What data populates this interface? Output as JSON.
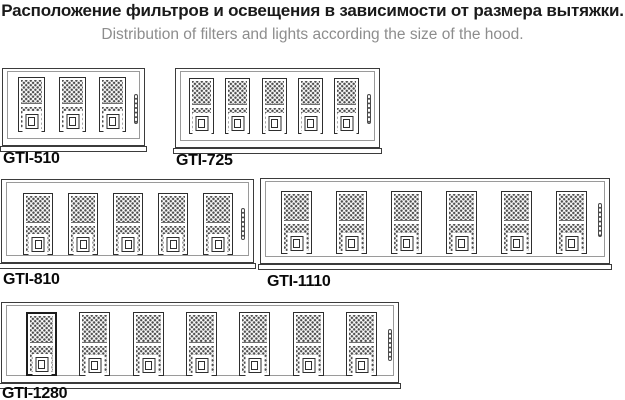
{
  "title_ru": "Расположение фильтров и освещения в зависимости от размера вытяжки.",
  "title_en": "Distribution of filters and lights according the size of the hood.",
  "colors": {
    "background": "#ffffff",
    "title": "#1a1a1a",
    "subtitle": "#8d8d8d",
    "outline": "#3b3b3b",
    "inner_line": "#9a9a9a",
    "mesh_dot": "#4d4d4d",
    "label": "#0a0a0a"
  },
  "hoods": [
    {
      "model": "GTI-510",
      "filters_count": 3,
      "lights_count": 1,
      "frame": {
        "x": 2,
        "y": 68,
        "w": 143,
        "h": 78
      },
      "filters": {
        "xs": [
          15,
          56,
          96
        ],
        "y": 8,
        "w": 27,
        "h": 55
      },
      "light": {
        "x": 131,
        "y": 25,
        "w": 4,
        "h": 30
      },
      "label": {
        "x": 3,
        "y": 150
      }
    },
    {
      "model": "GTI-725",
      "filters_count": 5,
      "lights_count": 1,
      "frame": {
        "x": 175,
        "y": 68,
        "w": 205,
        "h": 80
      },
      "filters": {
        "xs": [
          13,
          49,
          86,
          122,
          158
        ],
        "y": 9,
        "w": 25,
        "h": 56
      },
      "light": {
        "x": 191,
        "y": 25,
        "w": 4,
        "h": 30
      },
      "label": {
        "x": 176,
        "y": 152
      }
    },
    {
      "model": "GTI-810",
      "filters_count": 5,
      "lights_count": 1,
      "frame": {
        "x": 1,
        "y": 179,
        "w": 253,
        "h": 84
      },
      "filters": {
        "xs": [
          21,
          66,
          111,
          156,
          201
        ],
        "y": 13,
        "w": 30,
        "h": 62
      },
      "light": {
        "x": 239,
        "y": 28,
        "w": 4,
        "h": 32
      },
      "label": {
        "x": 3,
        "y": 271
      }
    },
    {
      "model": "GTI-1110",
      "filters_count": 6,
      "lights_count": 1,
      "frame": {
        "x": 260,
        "y": 178,
        "w": 350,
        "h": 86
      },
      "filters": {
        "xs": [
          20,
          75,
          130,
          185,
          240,
          295
        ],
        "y": 12,
        "w": 31,
        "h": 63
      },
      "light": {
        "x": 337,
        "y": 24,
        "w": 4,
        "h": 34
      },
      "label": {
        "x": 267,
        "y": 273
      }
    },
    {
      "model": "GTI-1280",
      "filters_count": 7,
      "lights_count": 1,
      "highlighted_filter": 0,
      "frame": {
        "x": 1,
        "y": 302,
        "w": 398,
        "h": 81
      },
      "filters": {
        "xs": [
          24,
          77,
          131,
          184,
          237,
          291,
          344
        ],
        "y": 9,
        "w": 31,
        "h": 64
      },
      "light": {
        "x": 386,
        "y": 26,
        "w": 4,
        "h": 32
      },
      "label": {
        "x": 2,
        "y": 385
      }
    }
  ]
}
